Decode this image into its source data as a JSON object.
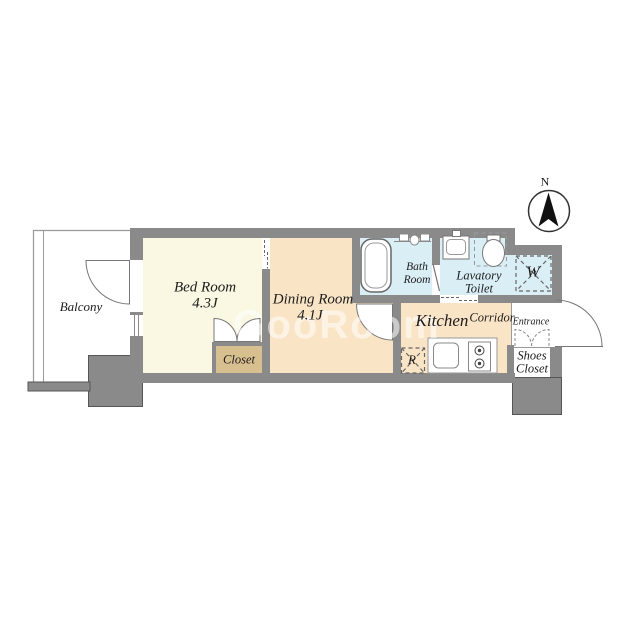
{
  "compass": {
    "north_label": "N"
  },
  "watermark": {
    "text": "GooRoom"
  },
  "rooms": {
    "balcony": {
      "label": "Balcony"
    },
    "bedroom": {
      "label": "Bed Room",
      "size": "4.3J"
    },
    "dining": {
      "label": "Dining Room",
      "size": "4.1J"
    },
    "closet": {
      "label": "Closet"
    },
    "bath": {
      "line1": "Bath",
      "line2": "Room"
    },
    "lavatory": {
      "line1": "Lavatory",
      "line2": "Toilet"
    },
    "washer": {
      "label": "W"
    },
    "refrigerator": {
      "label": "R"
    },
    "kitchen": {
      "label": "Kitchen"
    },
    "corridor": {
      "label": "Corridor"
    },
    "entrance": {
      "label": "Entrance"
    },
    "shoes_closet": {
      "line1": "Shoes",
      "line2": "Closet"
    }
  },
  "colors": {
    "wall": "#8a8a8a",
    "bedroom_floor": "#faf8e2",
    "dining_kitchen_floor": "#fae4c6",
    "wet_area_floor": "#daeef6",
    "closet_floor": "#d8bf90",
    "entrance_floor": "#ffffff"
  }
}
